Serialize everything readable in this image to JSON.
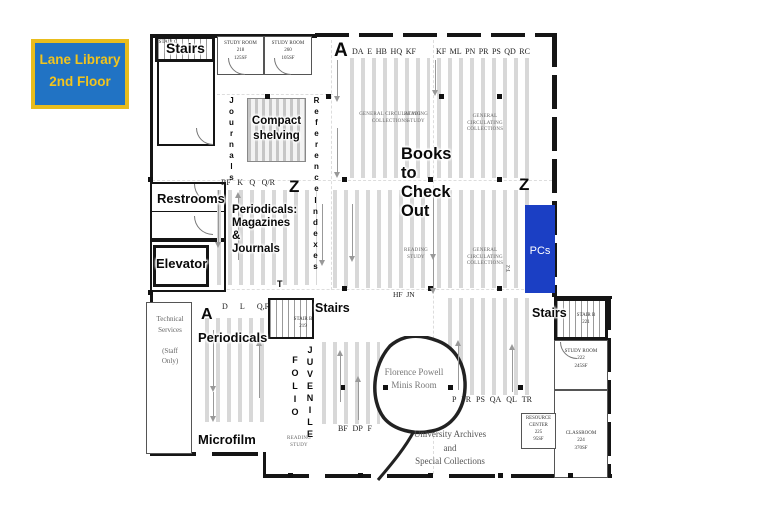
{
  "title_badge": {
    "line1": "Lane Library",
    "line2": "2nd Floor"
  },
  "rooms": {
    "stairs_top_left": {
      "label": "Stairs",
      "code": "STAIR C"
    },
    "stairs_middle": {
      "label": "Stairs",
      "code": "STAIR B",
      "number": "219"
    },
    "stairs_right": {
      "label": "Stairs",
      "code": "STAIR B",
      "number": "221"
    },
    "study_room_top_1": {
      "name": "STUDY ROOM",
      "number": "218",
      "area": "125SF"
    },
    "study_room_top_2": {
      "name": "STUDY ROOM",
      "number": "260",
      "area": "105SF"
    },
    "study_room_right": {
      "name": "STUDY ROOM",
      "number": "222",
      "area": "245SF"
    },
    "resource_center": {
      "name": "RESOURCE\nCENTER",
      "number": "225",
      "area": "95SF"
    },
    "classroom": {
      "name": "CLASSROOM",
      "number": "224",
      "area": "370SF"
    },
    "restrooms": "Restrooms",
    "elevator": "Elevator",
    "technical_services": "Technical\nServices\n\n(Staff\nOnly)",
    "florence_room": "Florence Powell\nMinis Room",
    "archives": "University Archives and\nSpecial Collections"
  },
  "collections": {
    "journals": "Journals",
    "compact_shelving": "Compact\nshelving",
    "reference": "Reference",
    "books_to_check_out": "Books\nto\nCheck\nOut",
    "periodicals_magazines": "Periodicals:\nMagazines\n&\nJournals",
    "indexes": "Indexes",
    "periodicals": "Periodicals",
    "microfilm": "Microfilm",
    "folio": "FOLIO",
    "juvenile": "JUVENILE",
    "pcs": "PCs",
    "general_circulating": "GENERAL CIRCULATING\nCOLLECTIONS",
    "reading_study": "READING\nSTUDY"
  },
  "call_numbers": {
    "big_a_top": "A",
    "big_a_bottom": "A",
    "z_left": "Z",
    "z_right": "Z",
    "t_label": "T",
    "hf_jn": "HF  JN",
    "pcs_side": "T-Z",
    "row_top_left": [
      "DA",
      "E",
      "HB",
      "HQ",
      "KF"
    ],
    "row_top_right": [
      "KF",
      "ML",
      "PN",
      "PR",
      "PS",
      "QD",
      "RC"
    ],
    "row_mid_left": [
      "BF",
      "K",
      "Q",
      "Q/R"
    ],
    "row_bottom_left": [
      "D",
      "L",
      "Q,R"
    ],
    "row_bottom_mid": [
      "BF",
      "DP",
      "F"
    ],
    "row_bottom_right": [
      "P",
      "PR",
      "PS",
      "QA",
      "QL",
      "TR"
    ]
  },
  "icons": {
    "aisle_arrow_up": "↑",
    "aisle_arrow_down": "↓"
  },
  "colors": {
    "badge_blue": "#2173c4",
    "badge_yellow": "#e9bd1d",
    "pcs_blue": "#1b3fc4",
    "shelf_stripe": "#d8d8d8",
    "wall": "#151515"
  }
}
